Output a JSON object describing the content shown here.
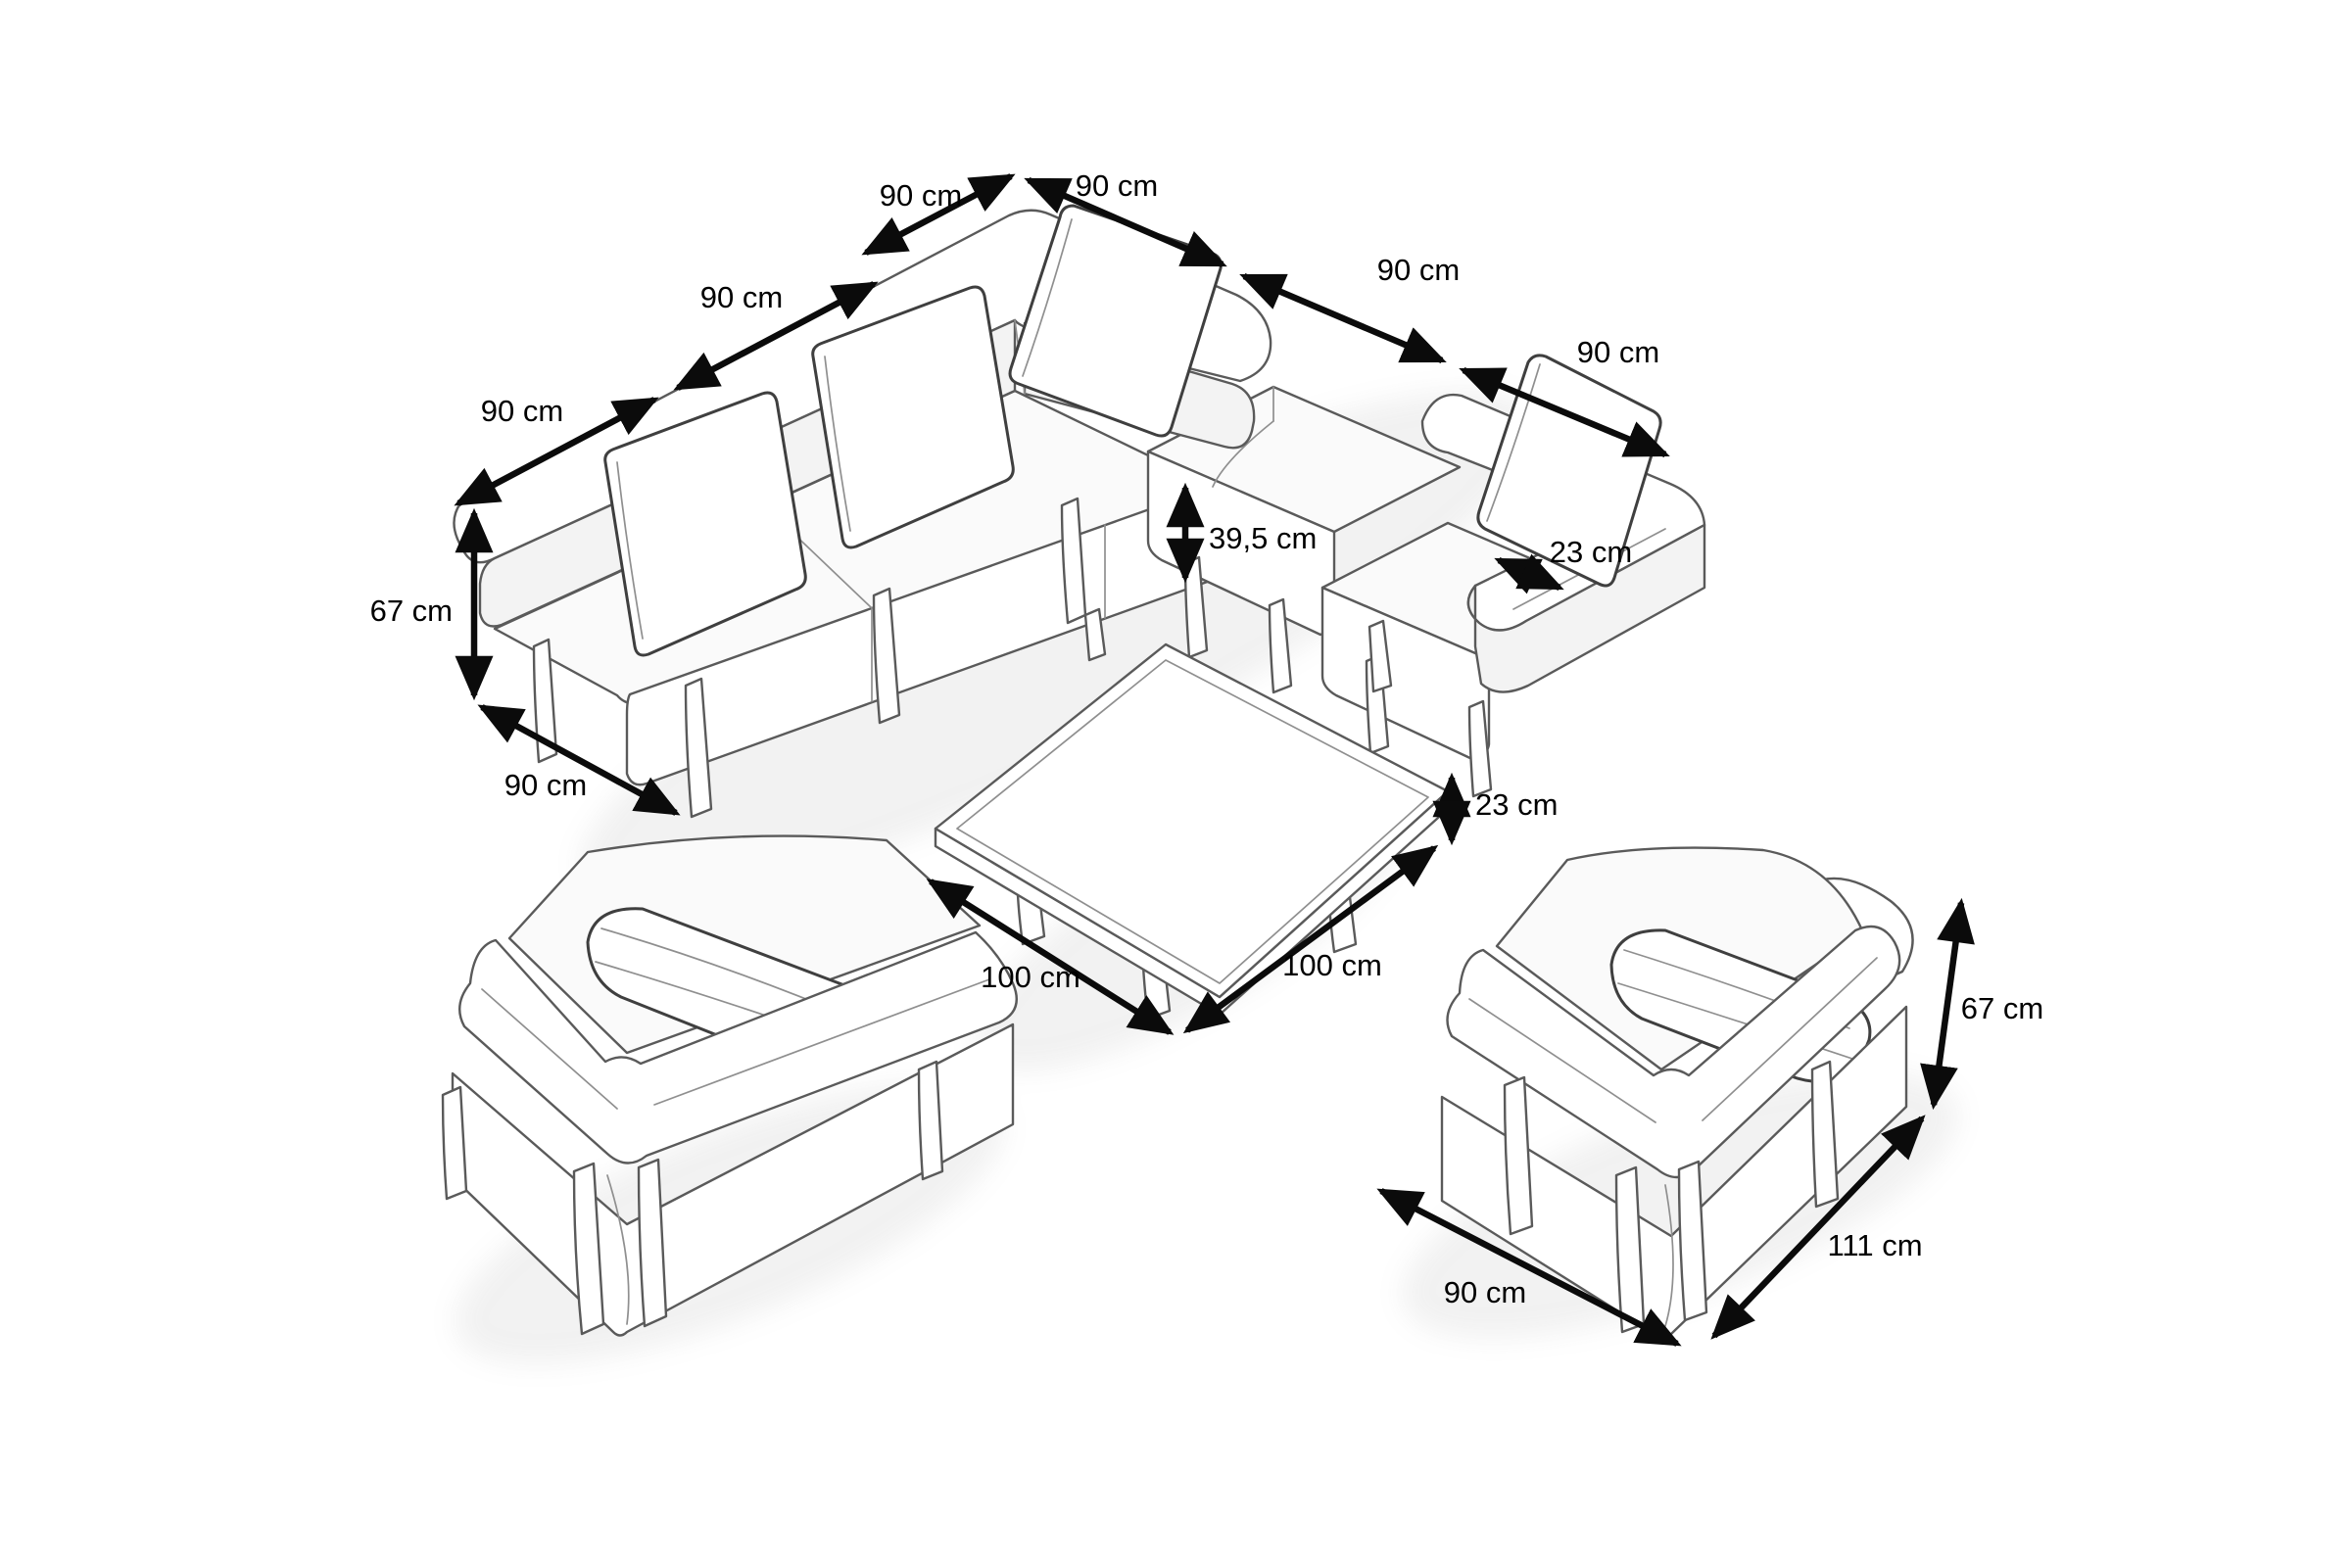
{
  "diagram": {
    "type": "furniture-dimension-diagram",
    "unit": "cm",
    "background": "#ffffff",
    "line_color": "#5a5a5a",
    "dimension_color": "#0b0b0b",
    "items": [
      "corner-sofa",
      "ottoman-module",
      "sofa-armchair-module",
      "coffee-table",
      "armchair-left",
      "armchair-right"
    ]
  },
  "dims": {
    "sofa_left_1": "90 cm",
    "sofa_left_2": "90 cm",
    "sofa_left_3": "90 cm",
    "sofa_top_1": "90 cm",
    "sofa_top_2": "90 cm",
    "sofa_top_3": "90 cm",
    "sofa_height": "67 cm",
    "sofa_depth": "90 cm",
    "sofa_seat_height": "39,5 cm",
    "sofa_armrest_width": "23 cm",
    "table_height": "23 cm",
    "table_side_left": "100 cm",
    "table_side_right": "100 cm",
    "armchair_height": "67 cm",
    "armchair_depth": "111 cm",
    "armchair_width": "90 cm"
  }
}
